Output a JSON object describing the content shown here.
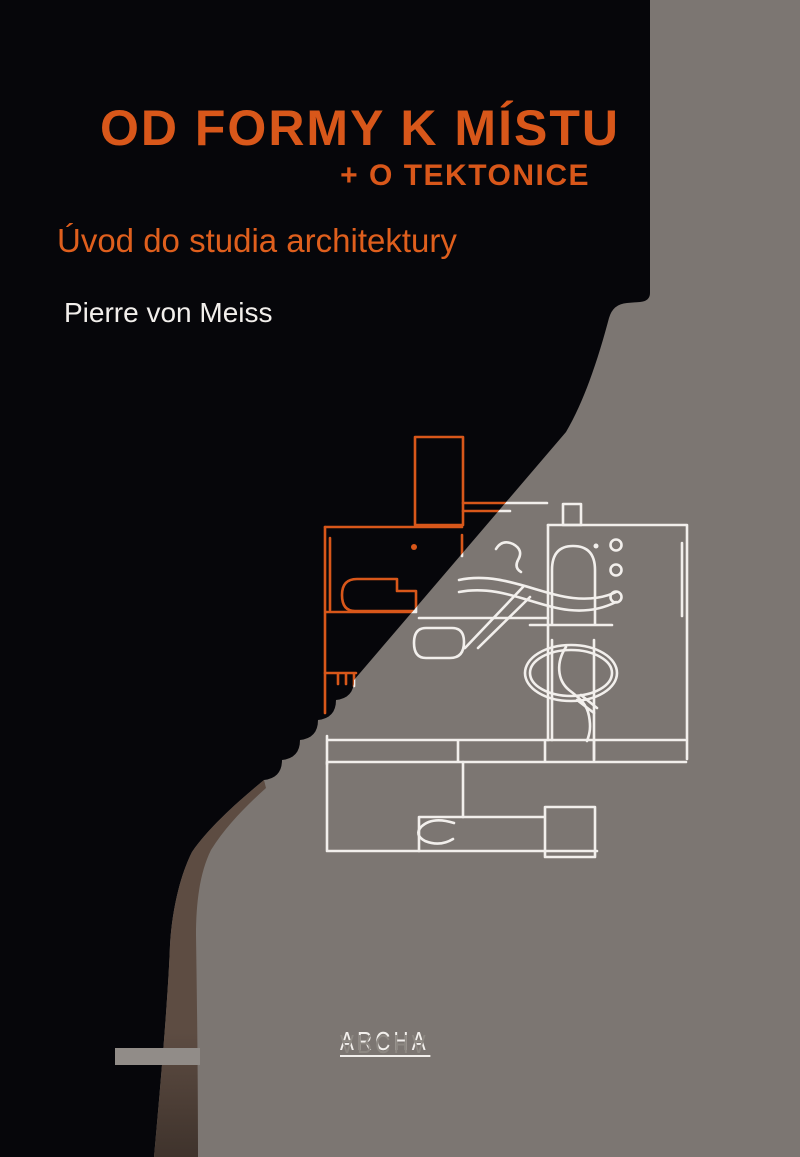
{
  "cover": {
    "title": "OD FORMY K MÍSTU",
    "subtitle": "+ O TEKTONICE",
    "tagline": "Úvod do studia architektury",
    "author": "Pierre von Meiss",
    "publisher_logo": "ARCHA",
    "publisher_logo_reflection": "ARCHA"
  },
  "colors": {
    "bg-black": "#06060a",
    "bg-gray": "#7c7672",
    "accent-orange": "#d8571a",
    "tagline-orange": "#df5f1d",
    "text-white": "#f2efec",
    "band-top": "#5d4c42",
    "band-bottom": "#3f332c",
    "bar-gray": "#918c88",
    "reflection-gray": "#8d8882"
  },
  "art": {
    "type": "architectural floor plan line drawing",
    "left_region": "orange outline plan on black field",
    "right_region": "white outline plan on gray field"
  }
}
